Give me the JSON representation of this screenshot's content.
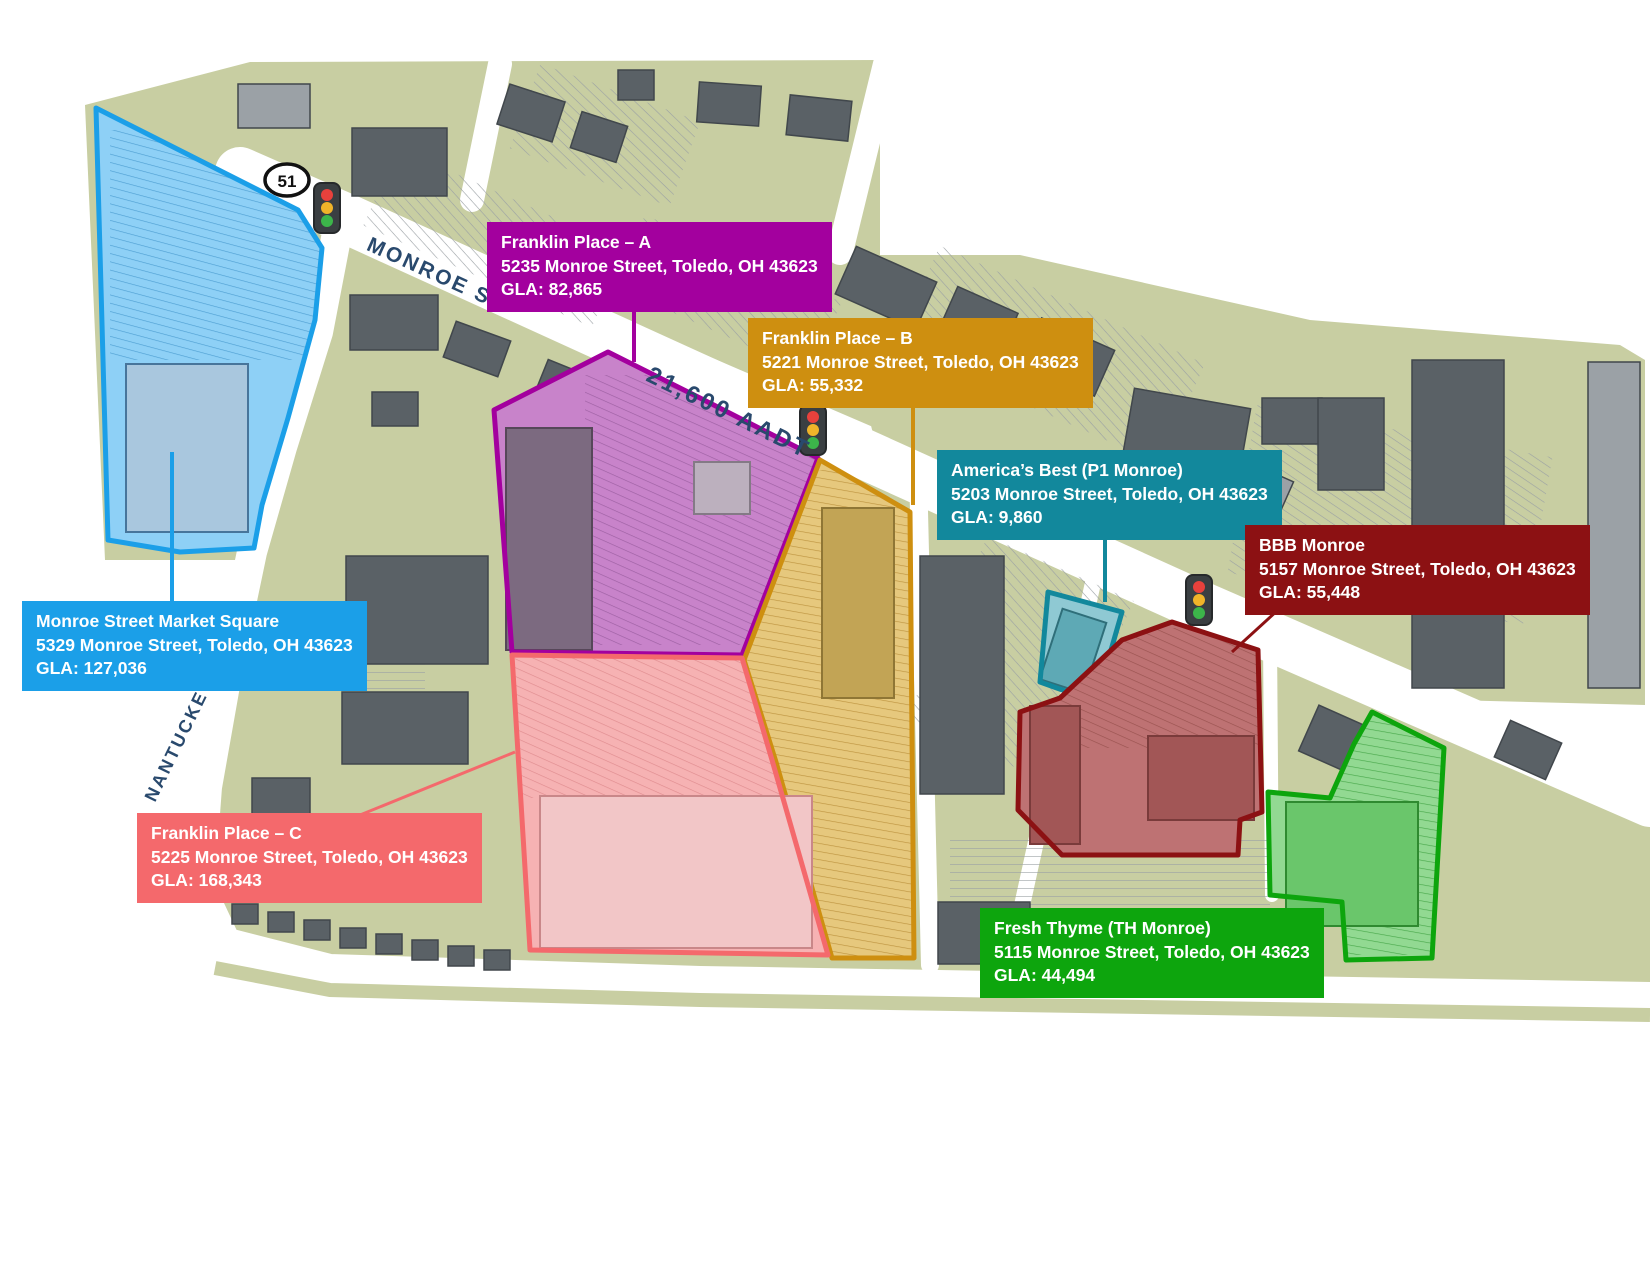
{
  "map": {
    "title": "Monroe Street retail site plan, Toledo OH",
    "parcels": [
      {
        "id": "monroe-street-market-square",
        "name": "Monroe Street Market Square",
        "address": "5329 Monroe Street, Toledo, OH 43623",
        "gla": "GLA: 127,036",
        "color": "#1B9FE8"
      },
      {
        "id": "franklin-place-a",
        "name": "Franklin Place – A",
        "address": "5235 Monroe Street, Toledo, OH 43623",
        "gla": "GLA: 82,865",
        "color": "#A3009E"
      },
      {
        "id": "franklin-place-b",
        "name": "Franklin Place – B",
        "address": "5221 Monroe Street, Toledo, OH 43623",
        "gla": "GLA: 55,332",
        "color": "#CE8F10"
      },
      {
        "id": "franklin-place-c",
        "name": "Franklin Place – C",
        "address": "5225 Monroe Street, Toledo, OH 43623",
        "gla": "GLA: 168,343",
        "color": "#F4696C"
      },
      {
        "id": "americas-best",
        "name": "America’s Best (P1 Monroe)",
        "address": "5203 Monroe Street, Toledo, OH 43623",
        "gla": "GLA: 9,860",
        "color": "#12889C"
      },
      {
        "id": "bbb-monroe",
        "name": "BBB Monroe",
        "address": "5157 Monroe Street, Toledo, OH 43623",
        "gla": "GLA: 55,448",
        "color": "#8C1113"
      },
      {
        "id": "fresh-thyme",
        "name": "Fresh Thyme (TH Monroe)",
        "address": "5115 Monroe Street, Toledo, OH 43623",
        "gla": "GLA: 44,494",
        "color": "#0DA50D"
      }
    ],
    "streets": {
      "monroe": "MONROE ST",
      "aadt": "21,600 AADT",
      "nantuckett": "NANTUCKETT DR",
      "route_marker": "51"
    }
  }
}
